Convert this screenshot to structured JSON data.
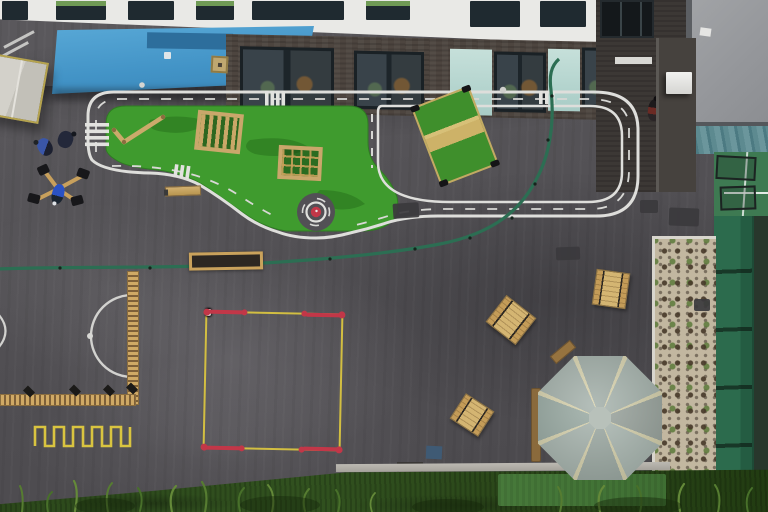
{
  "scene": {
    "description": "Aerial drone view of a school playground with road-safety track, play equipment, numbered grid markings and gazebo",
    "number_grid": {
      "numbers": [
        "1",
        "2",
        "3",
        "4",
        "5",
        "6",
        "7",
        "8",
        "9"
      ]
    },
    "colors": {
      "asphalt": "#555357",
      "track_line": "#dededb",
      "island_green": "#3f9b2e",
      "marking_yellow": "#d9c440",
      "marking_red": "#c23748",
      "roundabout_red": "#c23748",
      "rope_green": "#2c6e53",
      "fence_green": "#2c6b4d",
      "gravel": "#c2b7a0",
      "gazebo_roof": "#a8b4ae",
      "gazebo_rib": "#dcd6b2",
      "canopy_blue": "#4796c9",
      "wood": "#c8a05c",
      "grass": "#2c481b",
      "roof_grey": "#97999c"
    },
    "objects": {
      "road_track": "white road-safety track loop with dashed centre line and zebra crossings",
      "roundabout": "mini red roundabout",
      "island": "artificial grass island with wooden play equipment",
      "number_grid": "yellow 3x3 grid numbered 1 to 9 with red corners",
      "rope": "green skipping rope across tarmac",
      "gazebo": "octagonal timber gazebo with grey roof",
      "gravel_bed": "gravel planting bed with seedlings",
      "zigzag": "yellow zigzag marking",
      "circle_marking": "white semicircle marking with spot"
    }
  }
}
